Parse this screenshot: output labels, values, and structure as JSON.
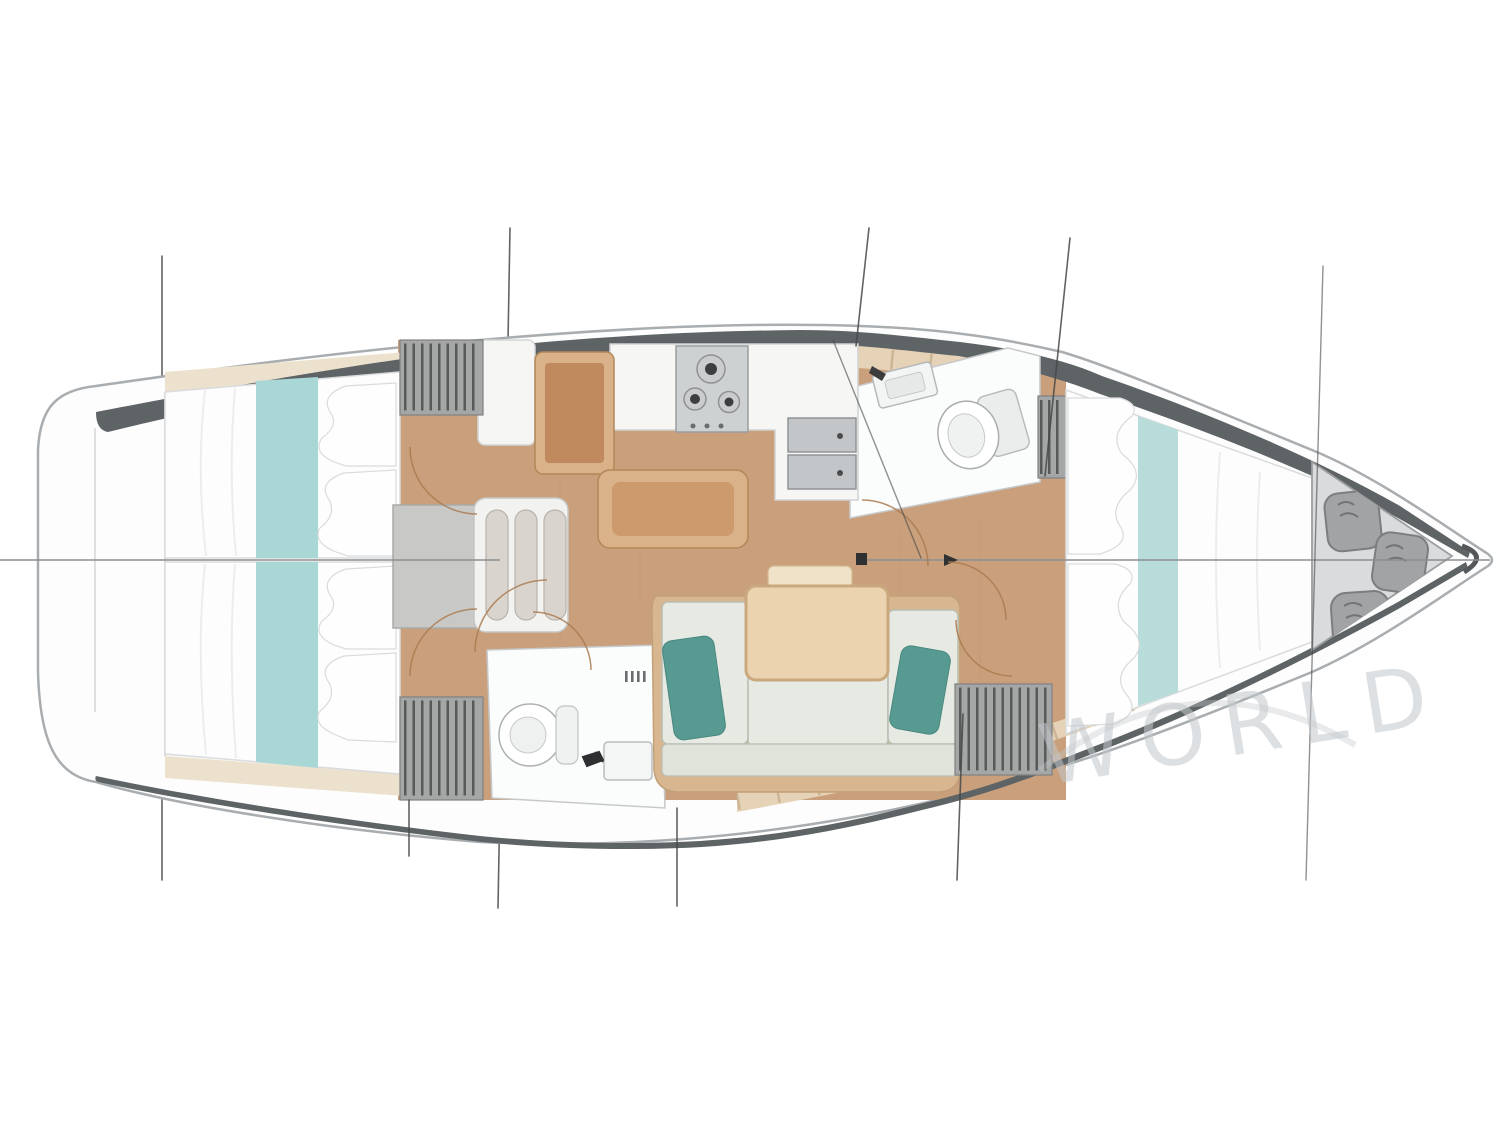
{
  "watermark": {
    "text": "WORLD"
  },
  "plan": {
    "type": "sailing-yacht-interior-floor-plan",
    "orientation": "bow-right",
    "rooms": [
      "aft-cabin-port",
      "aft-cabin-starboard",
      "salon-galley",
      "forward-head",
      "aft-head",
      "forward-cabin",
      "bow-sail-locker"
    ]
  },
  "palette": {
    "hull_outline": "#a9adb0",
    "band": "#5e6366",
    "deck": "#e6d2b6",
    "deck_seam": "#bfa888",
    "beige": "#ece1cd",
    "wood": "#c9a07b",
    "wood_dark": "#b78f6b",
    "white_room": "#fbfcfc",
    "room_line": "#c6c9cb",
    "bed": "#fdfdfe",
    "bed_line": "#d9dbdd",
    "teal": "#a9d7d5",
    "teal_fwd": "#b7dcda",
    "sofa": "#e7eae2",
    "sofa_line": "#b9beb3",
    "pillow_teal": "#579a92",
    "table": "#ecd3b0",
    "table_border": "#c9a87e",
    "tan_mid": "#c08a5e",
    "tan_light": "#dab28a",
    "locker": "#a5a6a6",
    "slat": "#57595b",
    "steel": "#ced1d2",
    "steel_dark": "#3c3e40",
    "bag": "#a2a3a4",
    "bag_dark": "#7c7d7f",
    "tri": "#dadbdc",
    "stay": "#46484a",
    "arc": "#aa7a50",
    "mark": "#2f3032",
    "water": "#c2c7cb"
  }
}
